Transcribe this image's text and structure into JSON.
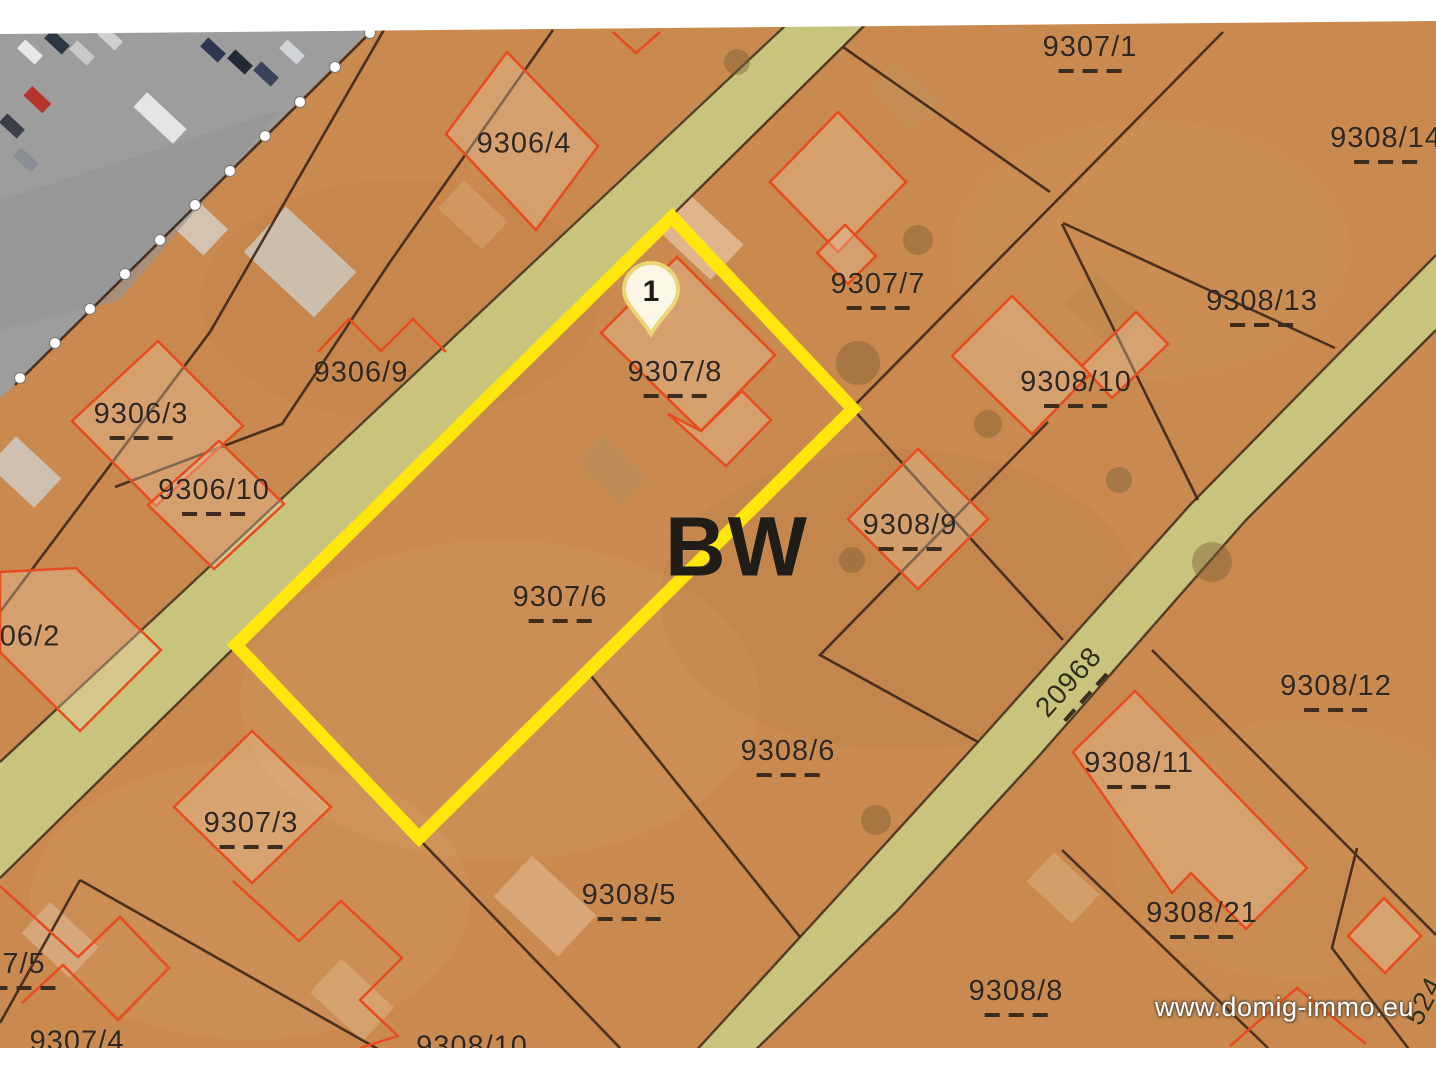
{
  "site": {
    "watermark": "www.domig-immo.eu"
  },
  "map": {
    "marker": {
      "label": "1"
    },
    "colors": {
      "parcel_base": "#c9894f",
      "road_fill": "#c9c47b",
      "boundary_line": "#3b2418",
      "building_outline": "#e84b1e",
      "highlight_yellow": "#ffe70d",
      "parking_gray": "#9d9d9d",
      "label_text": "#2f2720"
    },
    "labels": [
      {
        "text": "9307/1",
        "x": 1090,
        "y": 46,
        "dashes": 1
      },
      {
        "text": "9308/14",
        "x": 1386,
        "y": 137,
        "dashes": 1
      },
      {
        "text": "9306/4",
        "x": 524,
        "y": 144,
        "dashes": 0
      },
      {
        "text": "9307/7",
        "x": 878,
        "y": 283,
        "dashes": 1
      },
      {
        "text": "9308/13",
        "x": 1262,
        "y": 300,
        "dashes": 1
      },
      {
        "text": "9306/9",
        "x": 361,
        "y": 373,
        "dashes": 0
      },
      {
        "text": "9307/8",
        "x": 675,
        "y": 371,
        "dashes": 1
      },
      {
        "text": "9308/10",
        "x": 1076,
        "y": 381,
        "dashes": 1
      },
      {
        "text": "9306/3",
        "x": 141,
        "y": 413,
        "dashes": 1
      },
      {
        "text": "9306/10",
        "x": 214,
        "y": 489,
        "dashes": 1
      },
      {
        "text": "9308/9",
        "x": 910,
        "y": 524,
        "dashes": 1
      },
      {
        "text": "BW",
        "x": 737,
        "y": 547,
        "dashes": 0,
        "cls": "big"
      },
      {
        "text": "9307/6",
        "x": 560,
        "y": 596,
        "dashes": 1
      },
      {
        "text": "06/2",
        "x": 30,
        "y": 637,
        "dashes": 0
      },
      {
        "text": "20968",
        "x": 1072,
        "y": 679,
        "dashes": 1,
        "angle": -48,
        "cls": "street"
      },
      {
        "text": "9308/12",
        "x": 1336,
        "y": 685,
        "dashes": 1
      },
      {
        "text": "9308/6",
        "x": 788,
        "y": 750,
        "dashes": 1
      },
      {
        "text": "9308/11",
        "x": 1139,
        "y": 762,
        "dashes": 1
      },
      {
        "text": "9307/3",
        "x": 251,
        "y": 822,
        "dashes": 1
      },
      {
        "text": "9308/5",
        "x": 629,
        "y": 894,
        "dashes": 1
      },
      {
        "text": "9308/21",
        "x": 1202,
        "y": 912,
        "dashes": 1
      },
      {
        "text": "7/5",
        "x": 24,
        "y": 963,
        "dashes": 1
      },
      {
        "text": "9308/8",
        "x": 1016,
        "y": 990,
        "dashes": 1
      },
      {
        "text": "524",
        "x": 1424,
        "y": 1001,
        "dashes": 0,
        "angle": -62,
        "cls": "street"
      },
      {
        "text": "9307/4",
        "x": 77,
        "y": 1042,
        "dashes": 0
      },
      {
        "text": "9308/10",
        "x": 472,
        "y": 1047,
        "dashes": 0
      }
    ]
  }
}
